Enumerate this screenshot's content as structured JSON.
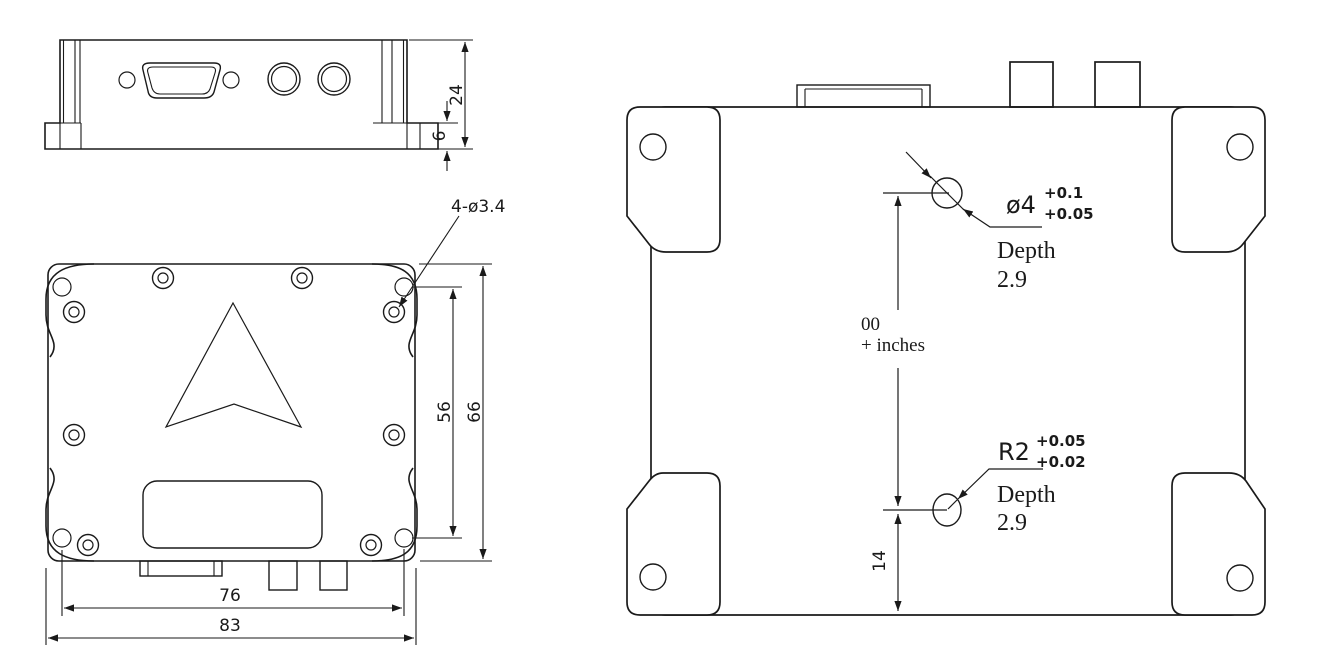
{
  "drawing": {
    "front_view": {
      "dim_height": "24",
      "dim_flange_height": "6"
    },
    "top_view": {
      "hole_callout": "4-ø3.4",
      "dim_hole_pitch_vertical": "56",
      "dim_body_height": "66",
      "dim_hole_pitch_horizontal": "76",
      "dim_overall_width": "83"
    },
    "bottom_view": {
      "alignment_hole": {
        "label": "ø4",
        "tolerance_upper": "+0.1",
        "tolerance_lower": "+0.05",
        "depth_label": "Depth",
        "depth_value": "2.9"
      },
      "origin_note": {
        "line1": "00",
        "line2": "+ inches"
      },
      "slot_hole": {
        "label": "R2",
        "tolerance_upper": "+0.05",
        "tolerance_lower": "+0.02",
        "depth_label": "Depth",
        "depth_value": "2.9"
      },
      "dim_hole_to_edge": "14"
    }
  },
  "colors": {
    "line": "#1a1a1a",
    "background": "#ffffff"
  }
}
